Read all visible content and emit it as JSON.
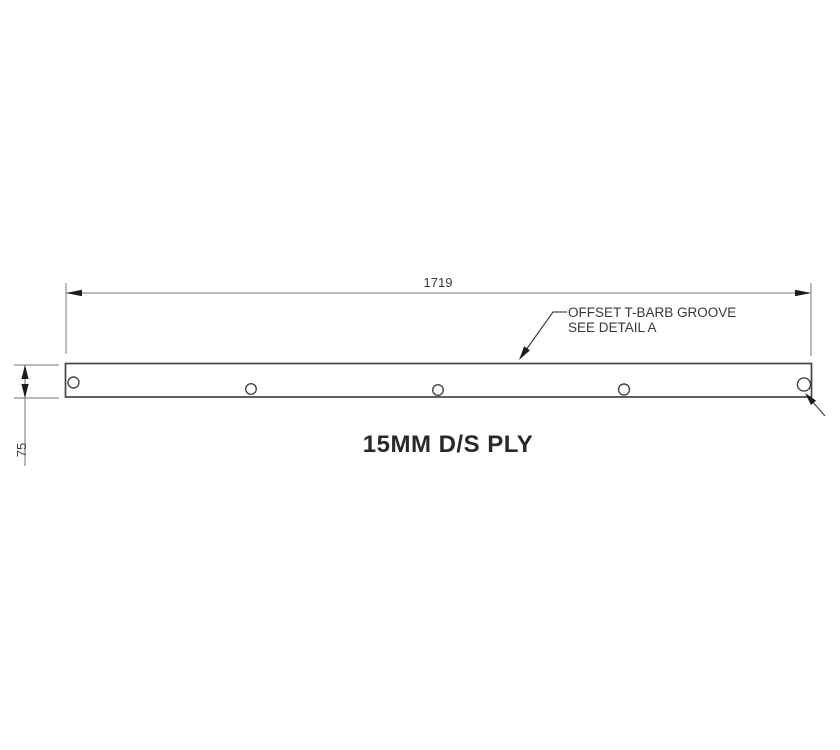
{
  "drawing": {
    "title": "15MM D/S PLY",
    "length_dimension": {
      "value": "1719"
    },
    "thickness_dimension": {
      "value": "75"
    },
    "groove_note": {
      "line1": "OFFSET T-BARB GROOVE",
      "line2": "SEE DETAIL A"
    },
    "holes_visible": 5,
    "colors": {
      "background": "#ffffff",
      "dimension_line": "#8f8f8f",
      "part_outline": "#454545",
      "arrowhead": "#1c1c1c",
      "dimension_text": "#3a3a3a",
      "title_text": "#262b28"
    }
  }
}
